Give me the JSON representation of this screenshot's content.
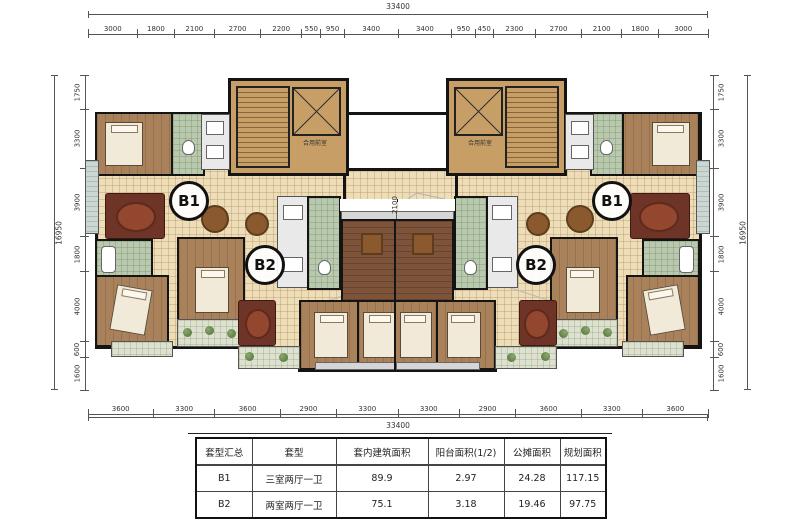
{
  "plan": {
    "b1_label": "B1",
    "b2_label": "B2",
    "core_lobby_label": "合用前室",
    "corridor_width_label": "2100"
  },
  "dims": {
    "top_overall": "33400",
    "bottom_overall": "33400",
    "left_overall": "16950",
    "right_overall": "16950",
    "top": [
      "3000",
      "1800",
      "2100",
      "2700",
      "2200",
      "550",
      "950",
      "3400",
      "3400",
      "950",
      "450",
      "2300",
      "2700",
      "2100",
      "1800",
      "3000"
    ],
    "bottom": [
      "3600",
      "3300",
      "3600",
      "2900",
      "3300",
      "3300",
      "2900",
      "3600",
      "3300",
      "3600"
    ],
    "left": [
      "1750",
      "3300",
      "3900",
      "1800",
      "4000",
      "600",
      "1600"
    ],
    "right": [
      "1750",
      "3300",
      "3900",
      "1800",
      "4000",
      "600",
      "1600"
    ]
  },
  "table": {
    "headers": [
      "套型汇总",
      "套型",
      "套内建筑面积",
      "阳台面积(1/2)",
      "公摊面积",
      "规划面积"
    ],
    "rows": [
      [
        "B1",
        "三室两厅一卫",
        "89.9",
        "2.97",
        "24.28",
        "117.15"
      ],
      [
        "B2",
        "两室两厅一卫",
        "75.1",
        "3.18",
        "19.46",
        "97.75"
      ]
    ]
  },
  "colors": {
    "wall": "#141414",
    "floor_tile": "#edddb8",
    "wood_floor": "#a9825c",
    "dark_wood_floor": "#7d5339",
    "core_floor": "#c79e66",
    "bath_tile": "#b9c9ad",
    "balcony_floor": "#ccd7d2",
    "window_gray": "#d6d6d6",
    "sofa_red": "#6e3427",
    "rug_red": "#93472f"
  }
}
